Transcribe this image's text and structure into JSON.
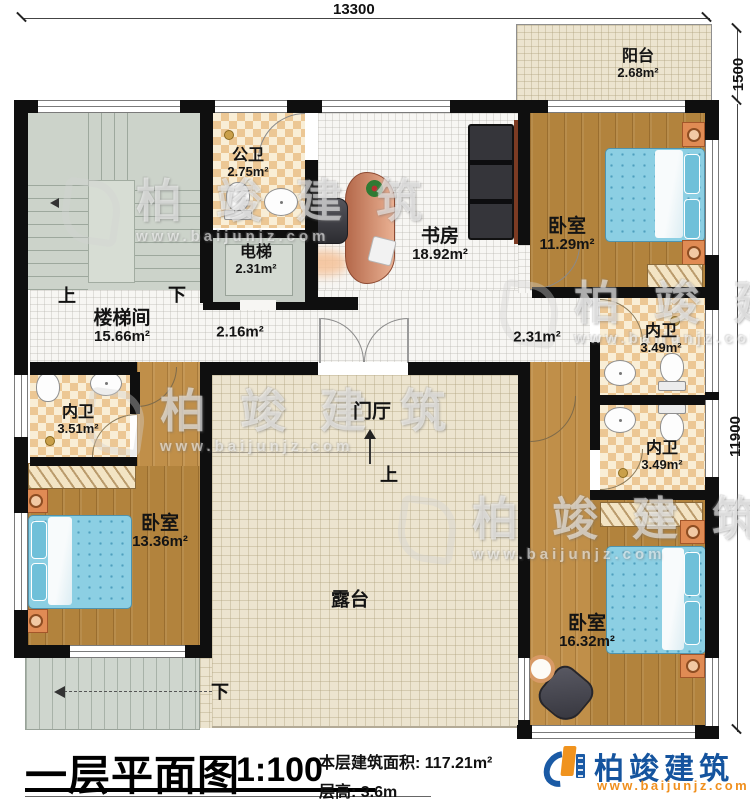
{
  "plan": {
    "dimensions": {
      "top": "13300",
      "right_upper": "1500",
      "right_lower": "11900"
    },
    "rooms": [
      {
        "name": "阳台",
        "area": "2.68m²"
      },
      {
        "name": "公卫",
        "area": "2.75m²"
      },
      {
        "name": "电梯",
        "area": "2.31m²"
      },
      {
        "name": "书房",
        "area": "18.92m²"
      },
      {
        "name": "卧室",
        "area": "11.29m²"
      },
      {
        "name": "楼梯间",
        "area": "15.66m²"
      },
      {
        "name": "内卫",
        "area": "3.49m²"
      },
      {
        "name": "内卫",
        "area": "3.51m²"
      },
      {
        "name": "内卫",
        "area": "3.49m²"
      },
      {
        "name": "卧室",
        "area": "13.36m²"
      },
      {
        "name": "卧室",
        "area": "16.32m²"
      },
      {
        "name": "门厅",
        "area": ""
      },
      {
        "name": "露台",
        "area": ""
      }
    ],
    "corridors": [
      {
        "area": "2.16m²"
      },
      {
        "area": "2.31m²"
      }
    ],
    "stair_labels": {
      "up": "上",
      "down": "下",
      "entry_up": "上",
      "exterior_down": "下"
    }
  },
  "title_block": {
    "title": "一层平面图",
    "scale": "1:100",
    "area_caption": "本层建筑面积: 117.21m²",
    "floor_height": "层高: 3.6m"
  },
  "logo": {
    "name": "柏竣建筑",
    "website": "www.baijunjz.com"
  },
  "watermark": {
    "brand": "柏竣建筑",
    "website": "www.baijunjz.com"
  },
  "colors": {
    "wall": "#0f0f0f",
    "wood_floor": "#b2833d",
    "checker_tile": "#ecc794",
    "terrace_tile": "#ece4cf",
    "stair_grey": "#ccd3ca",
    "bed_blue": "#8ccfe3",
    "nightstand_orange": "#e08b54",
    "logo_blue": "#15549e",
    "logo_orange": "#f08f1d"
  }
}
